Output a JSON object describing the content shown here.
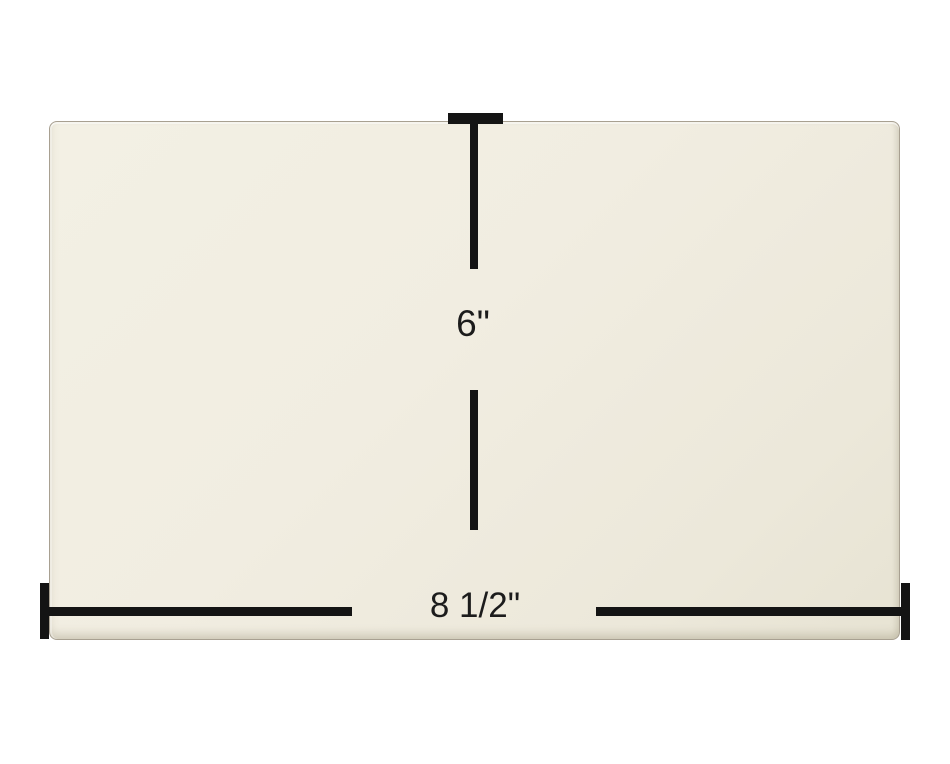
{
  "diagram": {
    "name": "panel-dimension-diagram",
    "height_dimension": {
      "label": "6\""
    },
    "width_dimension": {
      "label": "8 1/2\""
    },
    "colors": {
      "background": "#ffffff",
      "panel_fill": "#f1ede1",
      "panel_edge": "#a8a091",
      "dimension_line": "#141414",
      "label_text": "#1c1c1c"
    }
  }
}
